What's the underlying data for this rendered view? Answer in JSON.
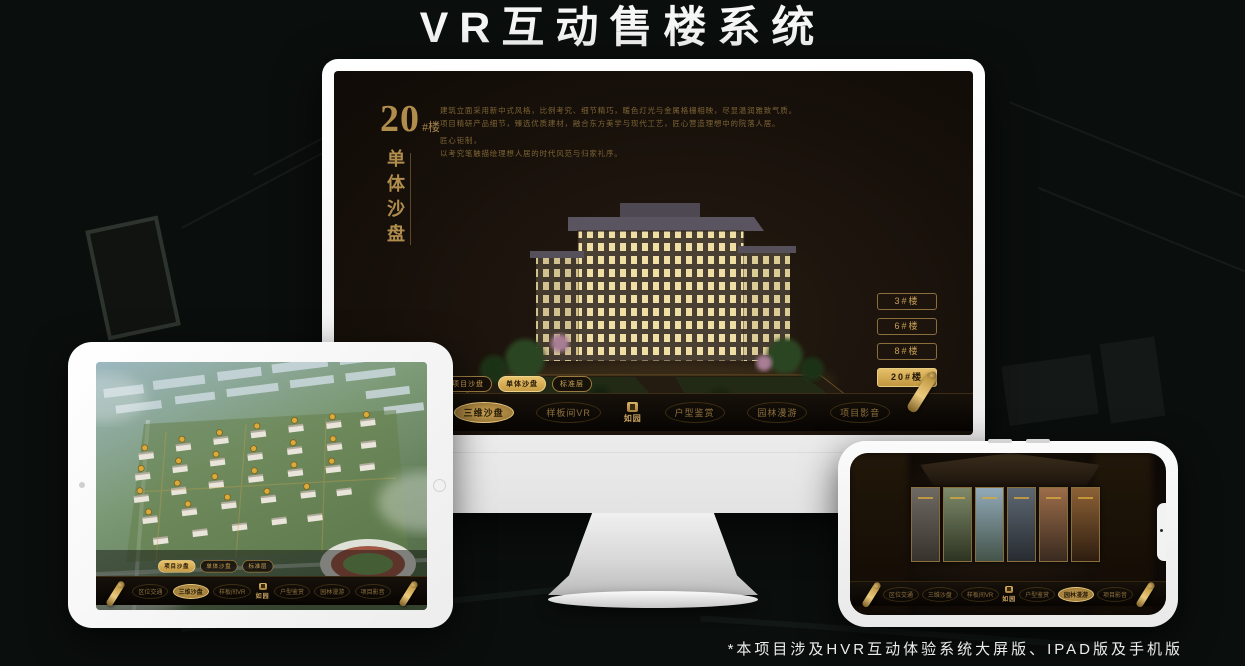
{
  "page": {
    "title": "VR互动售楼系统",
    "footnote": "*本项目涉及HVR互动体验系统大屏版、IPAD版及手机版"
  },
  "colors": {
    "gold": "#c9a155",
    "gold_bright": "#e9c36c",
    "screen_bg": "#17100a",
    "nav_bg": "#070402"
  },
  "monitor": {
    "building_no": "20",
    "building_no_suffix": "#楼",
    "vertical_title": "单体沙盘",
    "description_lines": [
      "建筑立面采用新中式风格，比例考究、细节精巧，暖色灯光与金属格栅相映，尽显温润雅致气质。",
      "项目精研产品细节，臻选优质建材，融合东方美学与现代工艺，匠心营造理想中的院落人居。",
      "匠心钜制，",
      "以考究笔触描绘理想人居的时代风范与归家礼序。"
    ],
    "building_buttons": [
      {
        "label": "3#楼",
        "active": false
      },
      {
        "label": "6#楼",
        "active": false
      },
      {
        "label": "8#楼",
        "active": false
      },
      {
        "label": "20#楼",
        "active": true
      }
    ],
    "subtabs": [
      {
        "label": "项目沙盘",
        "active": false
      },
      {
        "label": "单体沙盘",
        "active": true
      },
      {
        "label": "标准层",
        "active": false
      }
    ],
    "nav": {
      "logo": "如园",
      "items": [
        {
          "label": "区位交通",
          "active": false
        },
        {
          "label": "三维沙盘",
          "active": true
        },
        {
          "label": "样板间VR",
          "active": false
        },
        {
          "label": "户型鉴赏",
          "active": false
        },
        {
          "label": "园林漫游",
          "active": false
        },
        {
          "label": "项目影音",
          "active": false
        }
      ]
    }
  },
  "tablet": {
    "subtabs": [
      {
        "label": "项目沙盘",
        "active": true
      },
      {
        "label": "单体沙盘",
        "active": false
      },
      {
        "label": "标准层",
        "active": false
      }
    ],
    "nav": {
      "logo": "如园",
      "items": [
        {
          "label": "区位交通",
          "active": false
        },
        {
          "label": "三维沙盘",
          "active": true
        },
        {
          "label": "样板间VR",
          "active": false
        },
        {
          "label": "户型鉴赏",
          "active": false
        },
        {
          "label": "园林漫游",
          "active": false
        },
        {
          "label": "项目影音",
          "active": false
        }
      ]
    }
  },
  "phone": {
    "nav": {
      "logo": "如园",
      "items": [
        {
          "label": "区位交通",
          "active": false
        },
        {
          "label": "三维沙盘",
          "active": false
        },
        {
          "label": "样板间VR",
          "active": false
        },
        {
          "label": "户型鉴赏",
          "active": false
        },
        {
          "label": "园林漫游",
          "active": true
        },
        {
          "label": "项目影音",
          "active": false
        }
      ]
    }
  }
}
